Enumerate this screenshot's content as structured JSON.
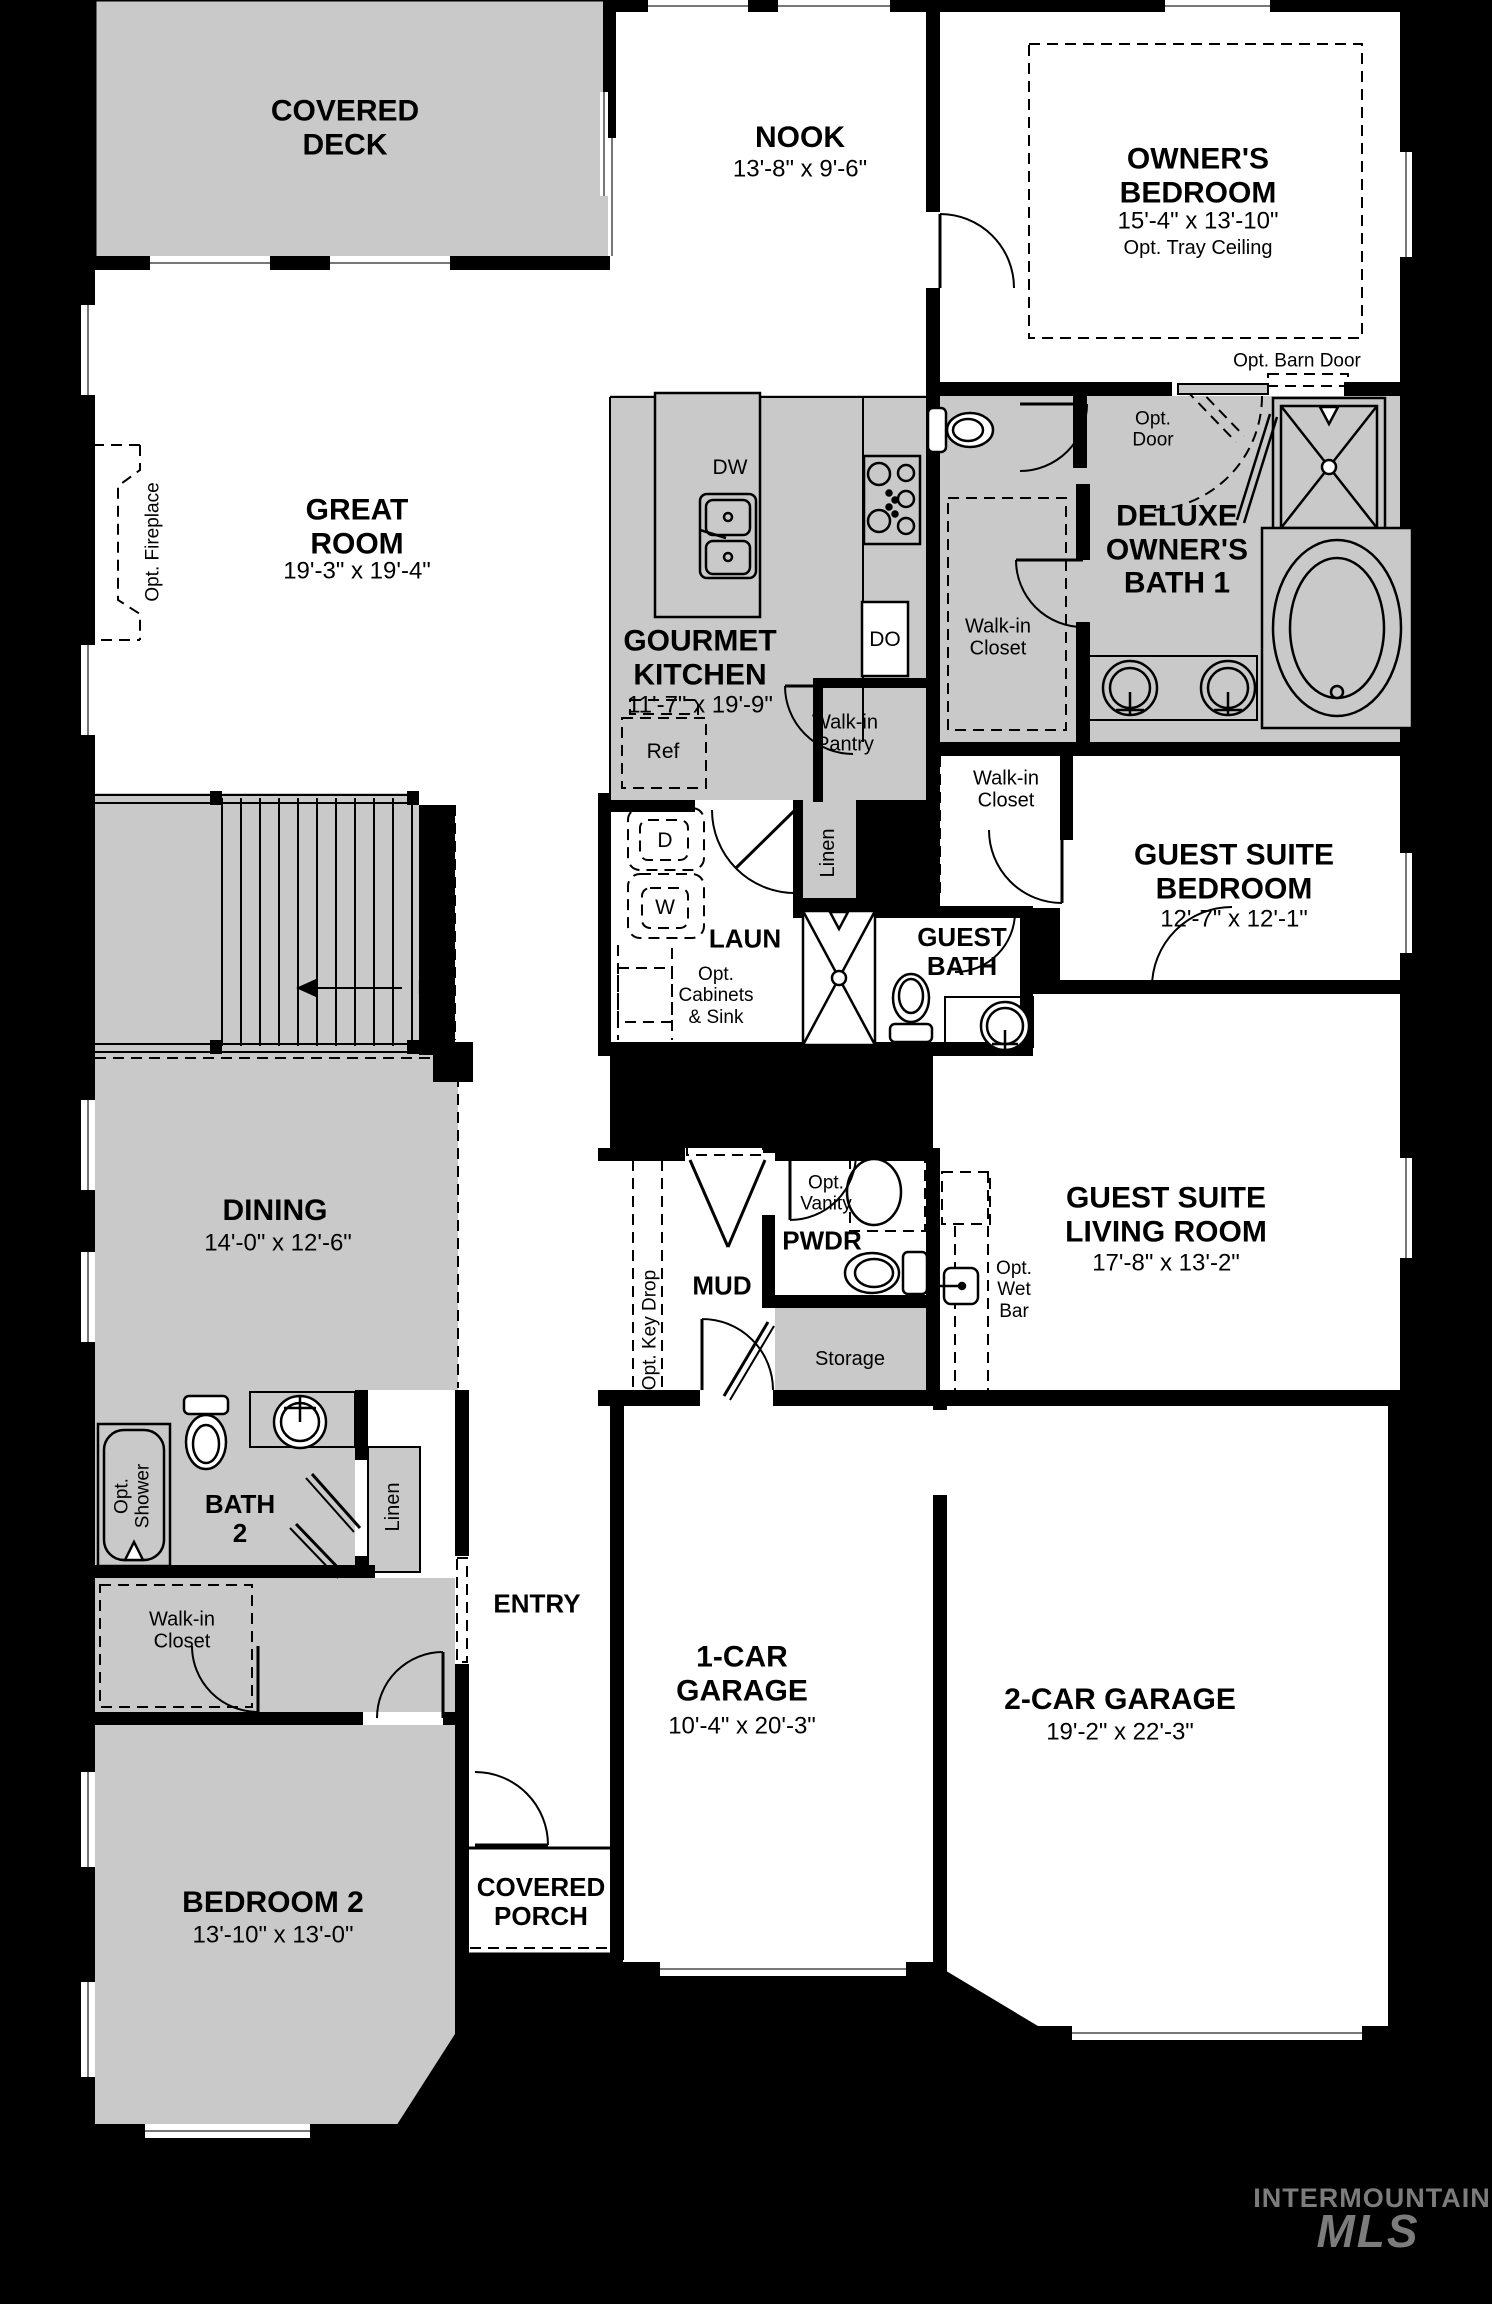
{
  "colors": {
    "background": "#000000",
    "floor": "#ffffff",
    "room_shaded": "#c9c9c9",
    "wall": "#000000",
    "watermark": "#7c7c7c"
  },
  "rooms": {
    "covered_deck": {
      "name": "COVERED\nDECK"
    },
    "nook": {
      "name": "NOOK",
      "dims": "13'-8\" x 9'-6\""
    },
    "owners_bedroom": {
      "name": "OWNER'S\nBEDROOM",
      "dims": "15'-4\" x 13'-10\"",
      "note": "Opt. Tray Ceiling"
    },
    "great_room": {
      "name": "GREAT\nROOM",
      "dims": "19'-3\" x 19'-4\""
    },
    "gourmet_kitchen": {
      "name": "GOURMET\nKITCHEN",
      "dims": "11'-7\" x 19'-9\""
    },
    "deluxe_owners_bath": {
      "name": "DELUXE\nOWNER'S\nBATH 1"
    },
    "owners_walk_in_closet": {
      "name": "Walk-in\nCloset"
    },
    "guest_walk_in_closet": {
      "name": "Walk-in\nCloset"
    },
    "guest_suite_bedroom": {
      "name": "GUEST SUITE\nBEDROOM",
      "dims": "12'-7\" x 12'-1\""
    },
    "laundry": {
      "name": "LAUN"
    },
    "guest_bath": {
      "name": "GUEST\nBATH"
    },
    "dining": {
      "name": "DINING",
      "dims": "14'-0\" x 12'-6\""
    },
    "mud": {
      "name": "MUD"
    },
    "pwdr": {
      "name": "PWDR"
    },
    "storage": {
      "name": "Storage"
    },
    "guest_suite_living": {
      "name": "GUEST SUITE\nLIVING ROOM",
      "dims": "17'-8\" x 13'-2\""
    },
    "bath_2": {
      "name": "BATH\n2"
    },
    "bedroom2_walk_in_closet": {
      "name": "Walk-in\nCloset"
    },
    "entry": {
      "name": "ENTRY"
    },
    "garage_1": {
      "name": "1-CAR\nGARAGE",
      "dims": "10'-4\" x 20'-3\""
    },
    "garage_2": {
      "name": "2-CAR GARAGE",
      "dims": "19'-2\" x 22'-3\""
    },
    "bedroom_2": {
      "name": "BEDROOM 2",
      "dims": "13'-10\" x 13'-0\""
    },
    "covered_porch": {
      "name": "COVERED\nPORCH"
    }
  },
  "annotations": {
    "opt_barn_door": "Opt. Barn Door",
    "opt_door": "Opt.\nDoor",
    "opt_fireplace": "Opt. Fireplace",
    "opt_tray_note": "Opt. Tray Ceiling",
    "opt_cabinets_sink": "Opt.\nCabinets\n& Sink",
    "opt_vanity": "Opt.\nVanity",
    "opt_key_drop": "Opt. Key Drop",
    "opt_wet_bar": "Opt.\nWet\nBar",
    "opt_shower": "Opt.\nShower",
    "down": "Dn",
    "linen_upper": "Linen",
    "linen_lower": "Linen",
    "walk_in_pantry": "Walk-in\nPantry",
    "dishwasher": "DW",
    "double_oven": "DO",
    "refrigerator": "Ref",
    "dryer": "D",
    "washer": "W"
  },
  "watermark": {
    "line1": "INTERMOUNTAIN",
    "line2": "MLS"
  }
}
